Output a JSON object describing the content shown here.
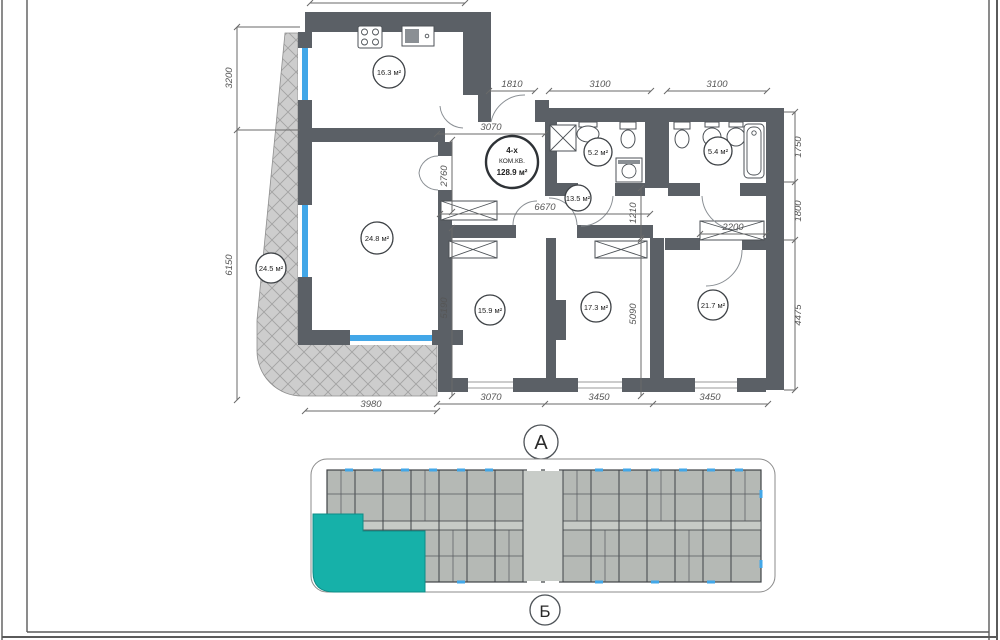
{
  "unit": {
    "type_line1": "4-х",
    "type_line2": "КОМ.КВ.",
    "total_area": "128.9 м²"
  },
  "rooms": {
    "kitchen": "16.3 м²",
    "living": "24.8 м²",
    "balcony": "24.5 м²",
    "bath_small": "5.2 м²",
    "bath_large": "5.4 м²",
    "hall": "13.5 м²",
    "bedroom_left": "15.9 м²",
    "bedroom_middle": "17.3 м²",
    "bedroom_right": "21.7 м²"
  },
  "dims": {
    "entry": "1810",
    "bath_small_width": "3100",
    "bath_large_width": "3100",
    "kitchen_width": "3070",
    "hall_depth": "2760",
    "corridor_length": "6670",
    "passage": "1210",
    "wardrobe": "2200",
    "left_upper": "3200",
    "left_lower": "6150",
    "right_upper": "1750",
    "right_middle": "1800",
    "right_lower": "4475",
    "bottom_balcony": "3980",
    "bottom_bedroom_left": "3070",
    "bottom_bedroom_middle": "3450",
    "bottom_bedroom_right": "3450",
    "bedroom_left_depth": "5190",
    "bedroom_middle_depth": "5090"
  },
  "keyplan": {
    "axis_top": "А",
    "axis_bottom": "Б"
  },
  "colors": {
    "wall": "#5b6066",
    "balcony_fill": "#cdcdcd",
    "highlight_unit": "#16b1a9",
    "window": "#42a7e8",
    "keyplan_unit_fill": "#b5b9b5"
  }
}
